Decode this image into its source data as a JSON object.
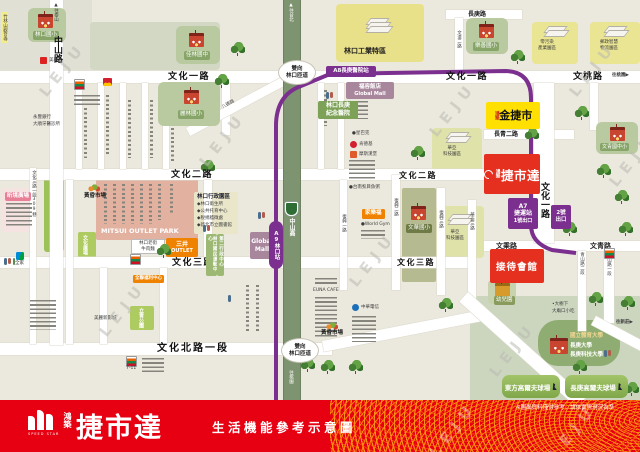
{
  "watermark": "LEJU",
  "banner": {
    "logo_sub": "SPEED STAR",
    "brand_prefix": "鴻築",
    "brand": "捷市達",
    "slogan": "生活機能參考示意圖",
    "disclaimer": "※圖面資料僅供參考，請依實際現況為準"
  },
  "roads": {
    "wenhua1_a": "文化一路",
    "wenhua1_b": "文化一路",
    "wentao": "文桃路",
    "wenhua2_a": "文化二路",
    "wenhua2_b": "文化二路",
    "wenhua3_a": "文化三路",
    "wenhua3_b": "文化三路",
    "wenhuabei": "文化北路一段",
    "changqing2": "長青二路",
    "wencheng": "文乘路",
    "wenqing": "文青路",
    "changgeng": "長庚路",
    "zhongshan": "中山路",
    "wenhua1_v": "文化一路",
    "wendao2": "文道二路",
    "lane309": "文化三路一段309巷",
    "fuxing1": "復興一路",
    "fuxing2": "復興二路",
    "fuxing3": "復興三路",
    "huaya3": "華亞三路",
    "qingshan2": "青山路二段",
    "qingshan1": "青山路一段",
    "zhongshangao": "中山高",
    "bade": "八德路"
  },
  "dir": {
    "taishan": "▲往泰山",
    "taipei": "▲往台北",
    "taoyuan_s": "往桃園",
    "taoyuan_e": "往桃園▶",
    "xinzhuang": "往新莊▶",
    "ramp_line1": "雙向",
    "ramp_line2": "林口匝道"
  },
  "mrt": {
    "a8": "A8長庚醫院站",
    "a9": "A9林口站",
    "a7_line1": "A7",
    "a7_line2": "捷運站",
    "a7_line3": "1號出口",
    "exit2_line1": "2號",
    "exit2_line2": "出口"
  },
  "proj": {
    "prefix_gold": "鴻築",
    "gold": "金捷市",
    "prefix_main": "鴻築",
    "main": "捷市達",
    "center": "接待會館"
  },
  "edu": {
    "linkou_es": "林口國小",
    "jialin_jh": "佳林國中",
    "lilin_es": "麗林國小",
    "leshan_es": "樂善國小",
    "wenqing_sch": "文青國中小",
    "wenhua_es": "文華國小",
    "kindergarten": "幼兒園",
    "ntsu": "國立體育大學",
    "cgu": "長庚大學",
    "cgust": "長庚科技大學"
  },
  "admin_zone": {
    "title": "林口行政園區",
    "b1": "◆林口衛生所",
    "b2": "◆公共托育中心",
    "b3": "◆稅捐稽徵處",
    "b4": "◆新北市立圖書館"
  },
  "poi": {
    "temple": "竹林山觀音寺",
    "mitsui_en": "MITSUI OUTLET PARK",
    "mitsui_zh1": "三井",
    "mitsui_zh2": "OUTLET",
    "beef1": "林口老街",
    "beef2": "牛肉麵",
    "xinjing": "昕境廣場",
    "market1": "黃昏市場",
    "market2": "黃昏市場",
    "meilixin": "美麗新影城",
    "pxmart": "全聯福利中心",
    "carrefour": "家樂福",
    "gmall1a": "福容飯店",
    "gmall1b": "Global Mall",
    "gmall2a": "Global",
    "gmall2b": "Mall",
    "hospital1": "林口長庚",
    "hospital2": "紀念醫院",
    "industry": "林口工業特區",
    "zero1": "零污染",
    "zero2": "產業園區",
    "post1": "郵政智慧",
    "post2": "物流園區",
    "huaya_a1": "華亞",
    "huaya_a2": "科技園區",
    "huaya_b1": "華亞",
    "huaya_b2": "科技園區",
    "sports_center": "林口國民運動中心",
    "admin2": "第二行政中心",
    "linkou_park": "林口公園",
    "wenhua_plaza": "文化廣場",
    "liqing_park": "立青公園",
    "golf_east": "東方高爾夫球場",
    "golf_cg": "長庚高爾夫球場",
    "tree_food1": "•大樹下",
    "tree_food2": "大廟口小吃",
    "family": "全家",
    "meilian": "美聯社",
    "bank": "永豐銀行",
    "dentist": "大順牙醫診所",
    "euna": "EUNA CAFE",
    "cht": "中華電信",
    "worldgym": "●World Gym",
    "fishporridge": "●台南虱目魚粥",
    "starbucks": "●星巴克",
    "kfc": "肯德基",
    "mos": "摩斯漢堡",
    "seven": "7-11"
  }
}
